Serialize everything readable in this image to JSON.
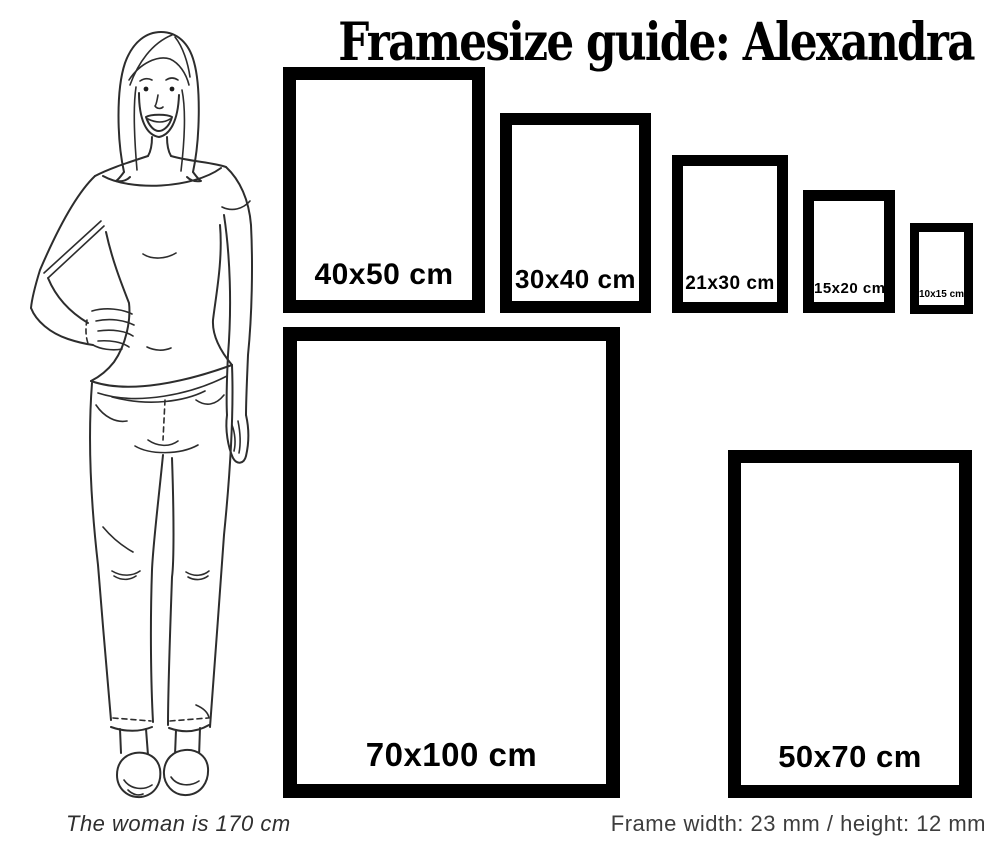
{
  "title": "Framesize guide: Alexandra",
  "frames": [
    {
      "size": "40x50",
      "label": "40x50 cm"
    },
    {
      "size": "30x40",
      "label": "30x40 cm"
    },
    {
      "size": "21x30",
      "label": "21x30 cm"
    },
    {
      "size": "15x20",
      "label": "15x20 cm"
    },
    {
      "size": "10x15",
      "label": "10x15 cm"
    },
    {
      "size": "70x100",
      "label": "70x100 cm"
    },
    {
      "size": "50x70",
      "label": "50x70 cm"
    }
  ],
  "footer": {
    "woman_note": "The woman is 170 cm",
    "frame_spec": "Frame width: 23 mm / height: 12 mm"
  },
  "colors": {
    "frame": "#000000",
    "title_text": "#000000",
    "footer_text": "#3d3d3d",
    "illustration_stroke": "#2d2d2d",
    "background": "#ffffff"
  }
}
